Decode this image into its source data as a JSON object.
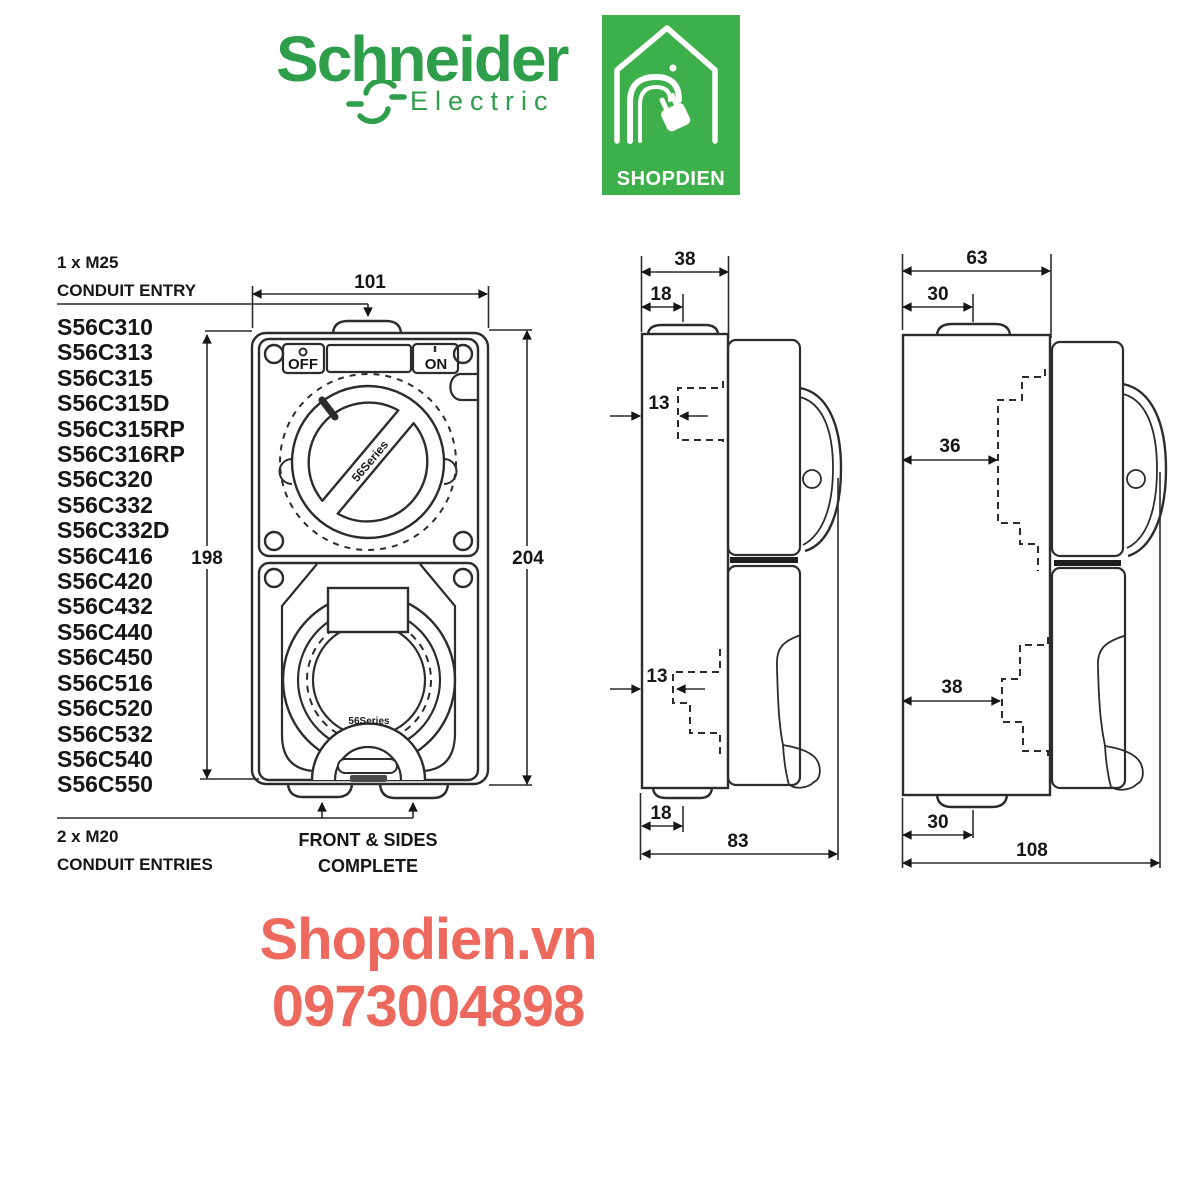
{
  "header": {
    "schneider": {
      "name": "Schneider",
      "sub": "Electric",
      "color": "#2f9e4a"
    },
    "shopdien": {
      "label": "SHOPDIEN",
      "bg": "#3db04c"
    }
  },
  "parts_list": {
    "top_note_line1": "1 x M25",
    "top_note_line2": "CONDUIT ENTRY",
    "models": [
      "S56C310",
      "S56C313",
      "S56C315",
      "S56C315D",
      "S56C315RP",
      "S56C316RP",
      "S56C320",
      "S56C332",
      "S56C332D",
      "S56C416",
      "S56C420",
      "S56C432",
      "S56C440",
      "S56C450",
      "S56C516",
      "S56C520",
      "S56C532",
      "S56C540",
      "S56C550"
    ],
    "bottom_note_line1": "2 x M20",
    "bottom_note_line2": "CONDUIT ENTRIES"
  },
  "front_view": {
    "dims": {
      "width": "101",
      "face_height": "198",
      "overall_height": "204"
    },
    "switch": {
      "off": "OFF",
      "on": "ON"
    },
    "series_mark": "56Series",
    "caption_line1": "FRONT & SIDES",
    "caption_line2": "COMPLETE"
  },
  "side_view_small": {
    "dims": {
      "top_width": "38",
      "top_entry_offset": "18",
      "upper_knockout": "13",
      "lower_knockout": "13",
      "bottom_entry_offset": "18",
      "depth": "83"
    }
  },
  "side_view_large": {
    "dims": {
      "top_width": "63",
      "top_entry_offset": "30",
      "upper_knockout": "36",
      "lower_knockout": "38",
      "bottom_entry_offset": "30",
      "depth": "108"
    }
  },
  "footer": {
    "website": "Shopdien.vn",
    "phone": "0973004898",
    "color": "#ed695e"
  }
}
